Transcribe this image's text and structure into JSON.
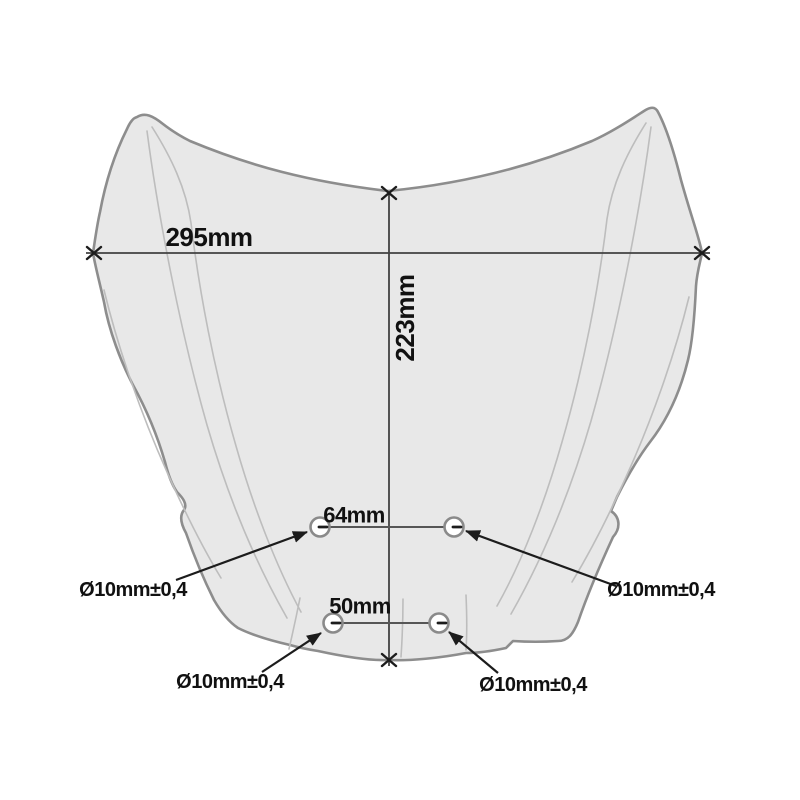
{
  "labels": {
    "width": "295mm",
    "height": "223mm",
    "upper_hole_spacing": "64mm",
    "lower_hole_spacing": "50mm",
    "dia_upper_left": "Ø10mm±0,4",
    "dia_upper_right": "Ø10mm±0,4",
    "dia_lower_left": "Ø10mm±0,4",
    "dia_lower_right": "Ø10mm±0,4"
  },
  "colors": {
    "background": "#ffffff",
    "windscreen_fill": "#e8e8e8",
    "windscreen_outline": "#8d8d8d",
    "crease_line": "#bdbdbd",
    "dimension_line": "#424242",
    "marker_and_arrow": "#1c1c1c",
    "label_text": "#111111",
    "hole_fill": "#ffffff",
    "hole_stroke": "#8a8a8a"
  }
}
